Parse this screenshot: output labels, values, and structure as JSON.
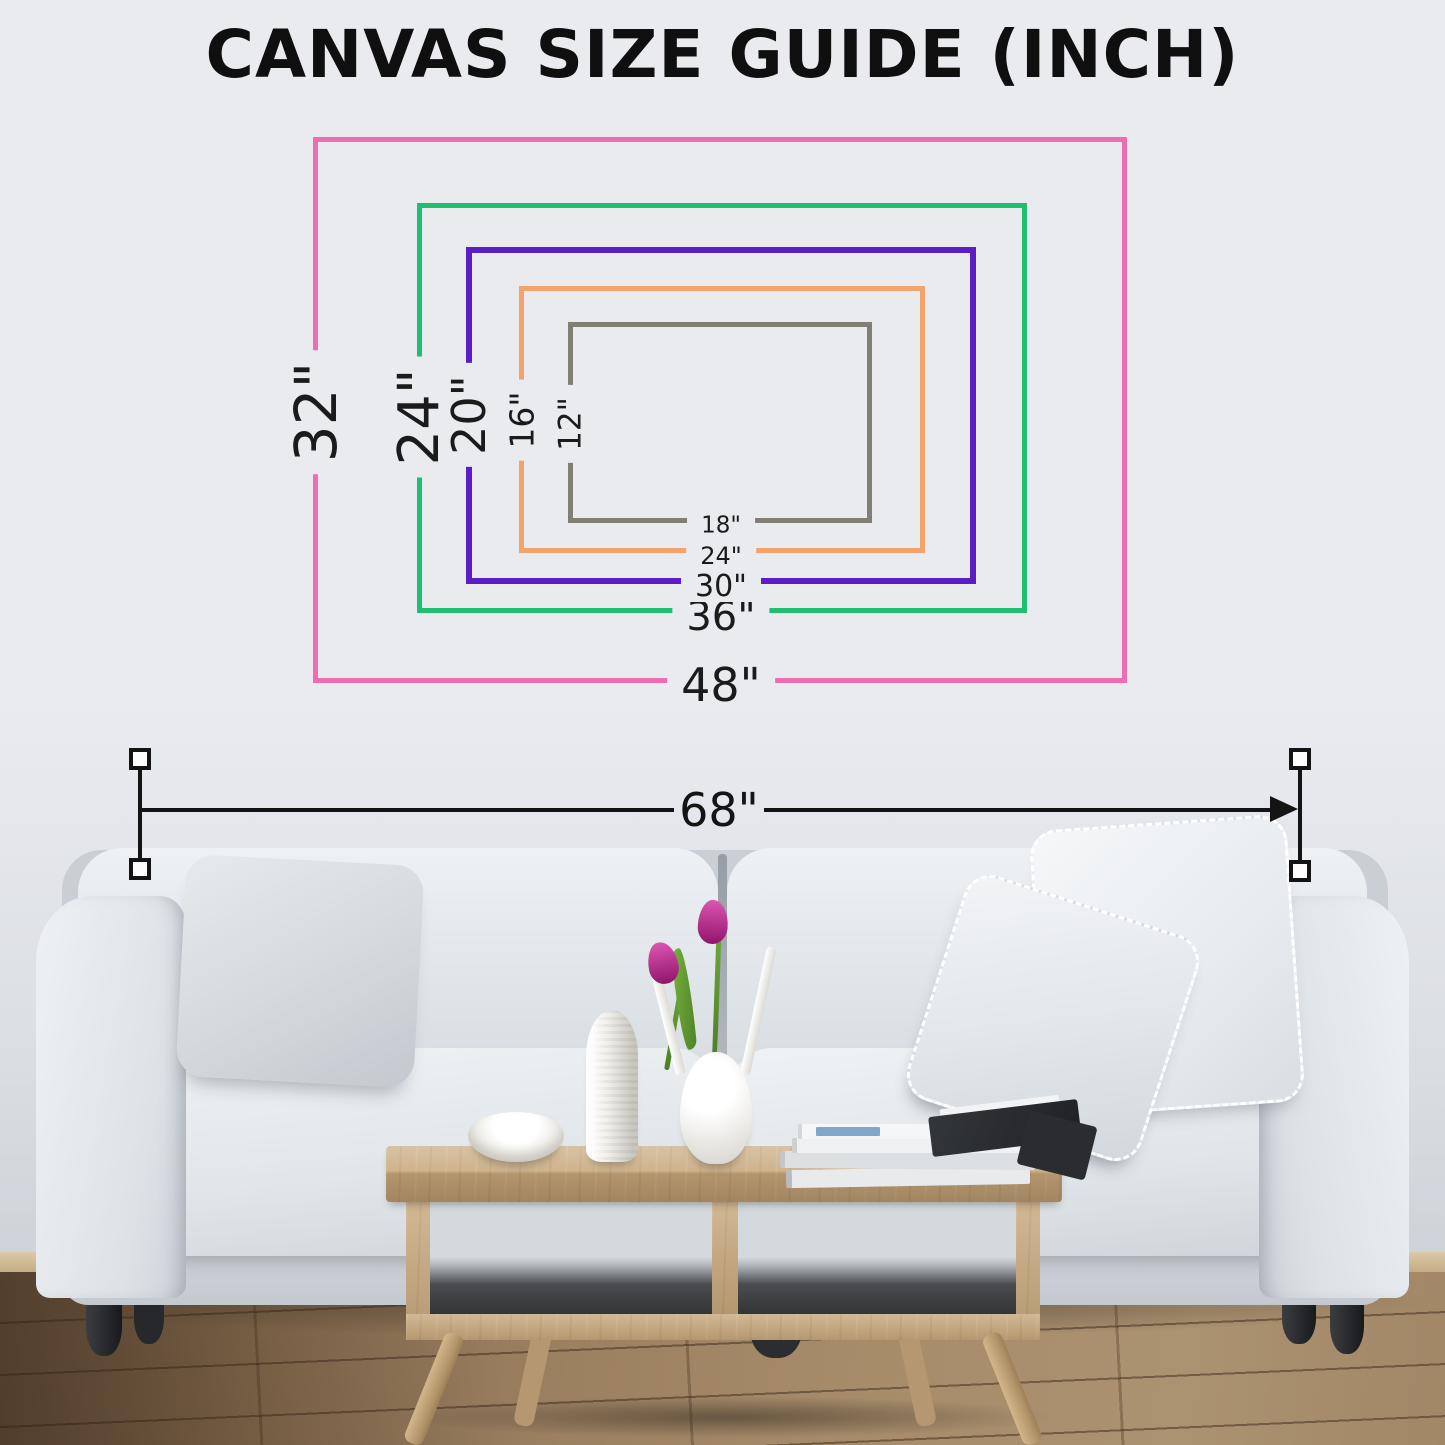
{
  "title": "CANVAS SIZE GUIDE (INCH)",
  "size_guide": {
    "rectangles": [
      {
        "size": "48x32",
        "width_label": "48\"",
        "height_label": "32\"",
        "color": "#ee6db2"
      },
      {
        "size": "36x24",
        "width_label": "36\"",
        "height_label": "24\"",
        "color": "#1fbe71"
      },
      {
        "size": "30x20",
        "width_label": "30\"",
        "height_label": "20\"",
        "color": "#5a1ec4"
      },
      {
        "size": "24x16",
        "width_label": "24\"",
        "height_label": "16\"",
        "color": "#f3a46d"
      },
      {
        "size": "18x12",
        "width_label": "18\"",
        "height_label": "12\"",
        "color": "#807e75"
      }
    ]
  },
  "wall_measurement": {
    "label": "68\""
  },
  "scene": {
    "colors": {
      "wall": "#e9ebef",
      "floor_wood": "#9c8161",
      "table_wood": "#c8a97d",
      "sofa_fabric": "#e3e7eb",
      "tulip": "#cf1d98",
      "measure_line": "#141414"
    }
  }
}
